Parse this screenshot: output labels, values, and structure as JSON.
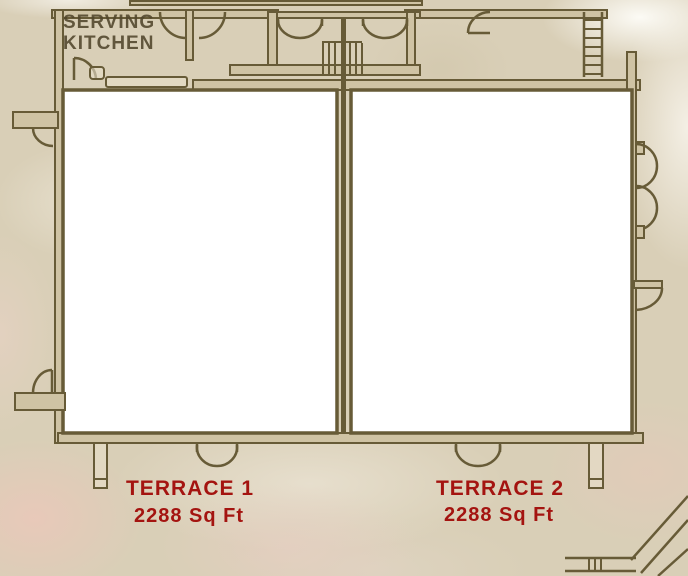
{
  "plan_title": "Terrace floor plan",
  "rooms": {
    "kitchen": {
      "line1": "SERVING",
      "line2": "KITCHEN"
    },
    "terrace1": {
      "name": "TERRACE 1",
      "area": "2288 Sq Ft"
    },
    "terrace2": {
      "name": "TERRACE 2",
      "area": "2288 Sq Ft"
    }
  },
  "colors": {
    "wall": "#675b37",
    "wall_fill": "#cfc3a4",
    "room_fill": "#ffffff",
    "room_label": "#a41410",
    "kitchen_label": "#51462c",
    "background": "#d9cfb7"
  },
  "icons": [
    "double-door-icon",
    "stairs-icon",
    "ladder-icon",
    "door-swing-icon",
    "pillar",
    "ramp-icon",
    "counter",
    "sink-icon"
  ]
}
